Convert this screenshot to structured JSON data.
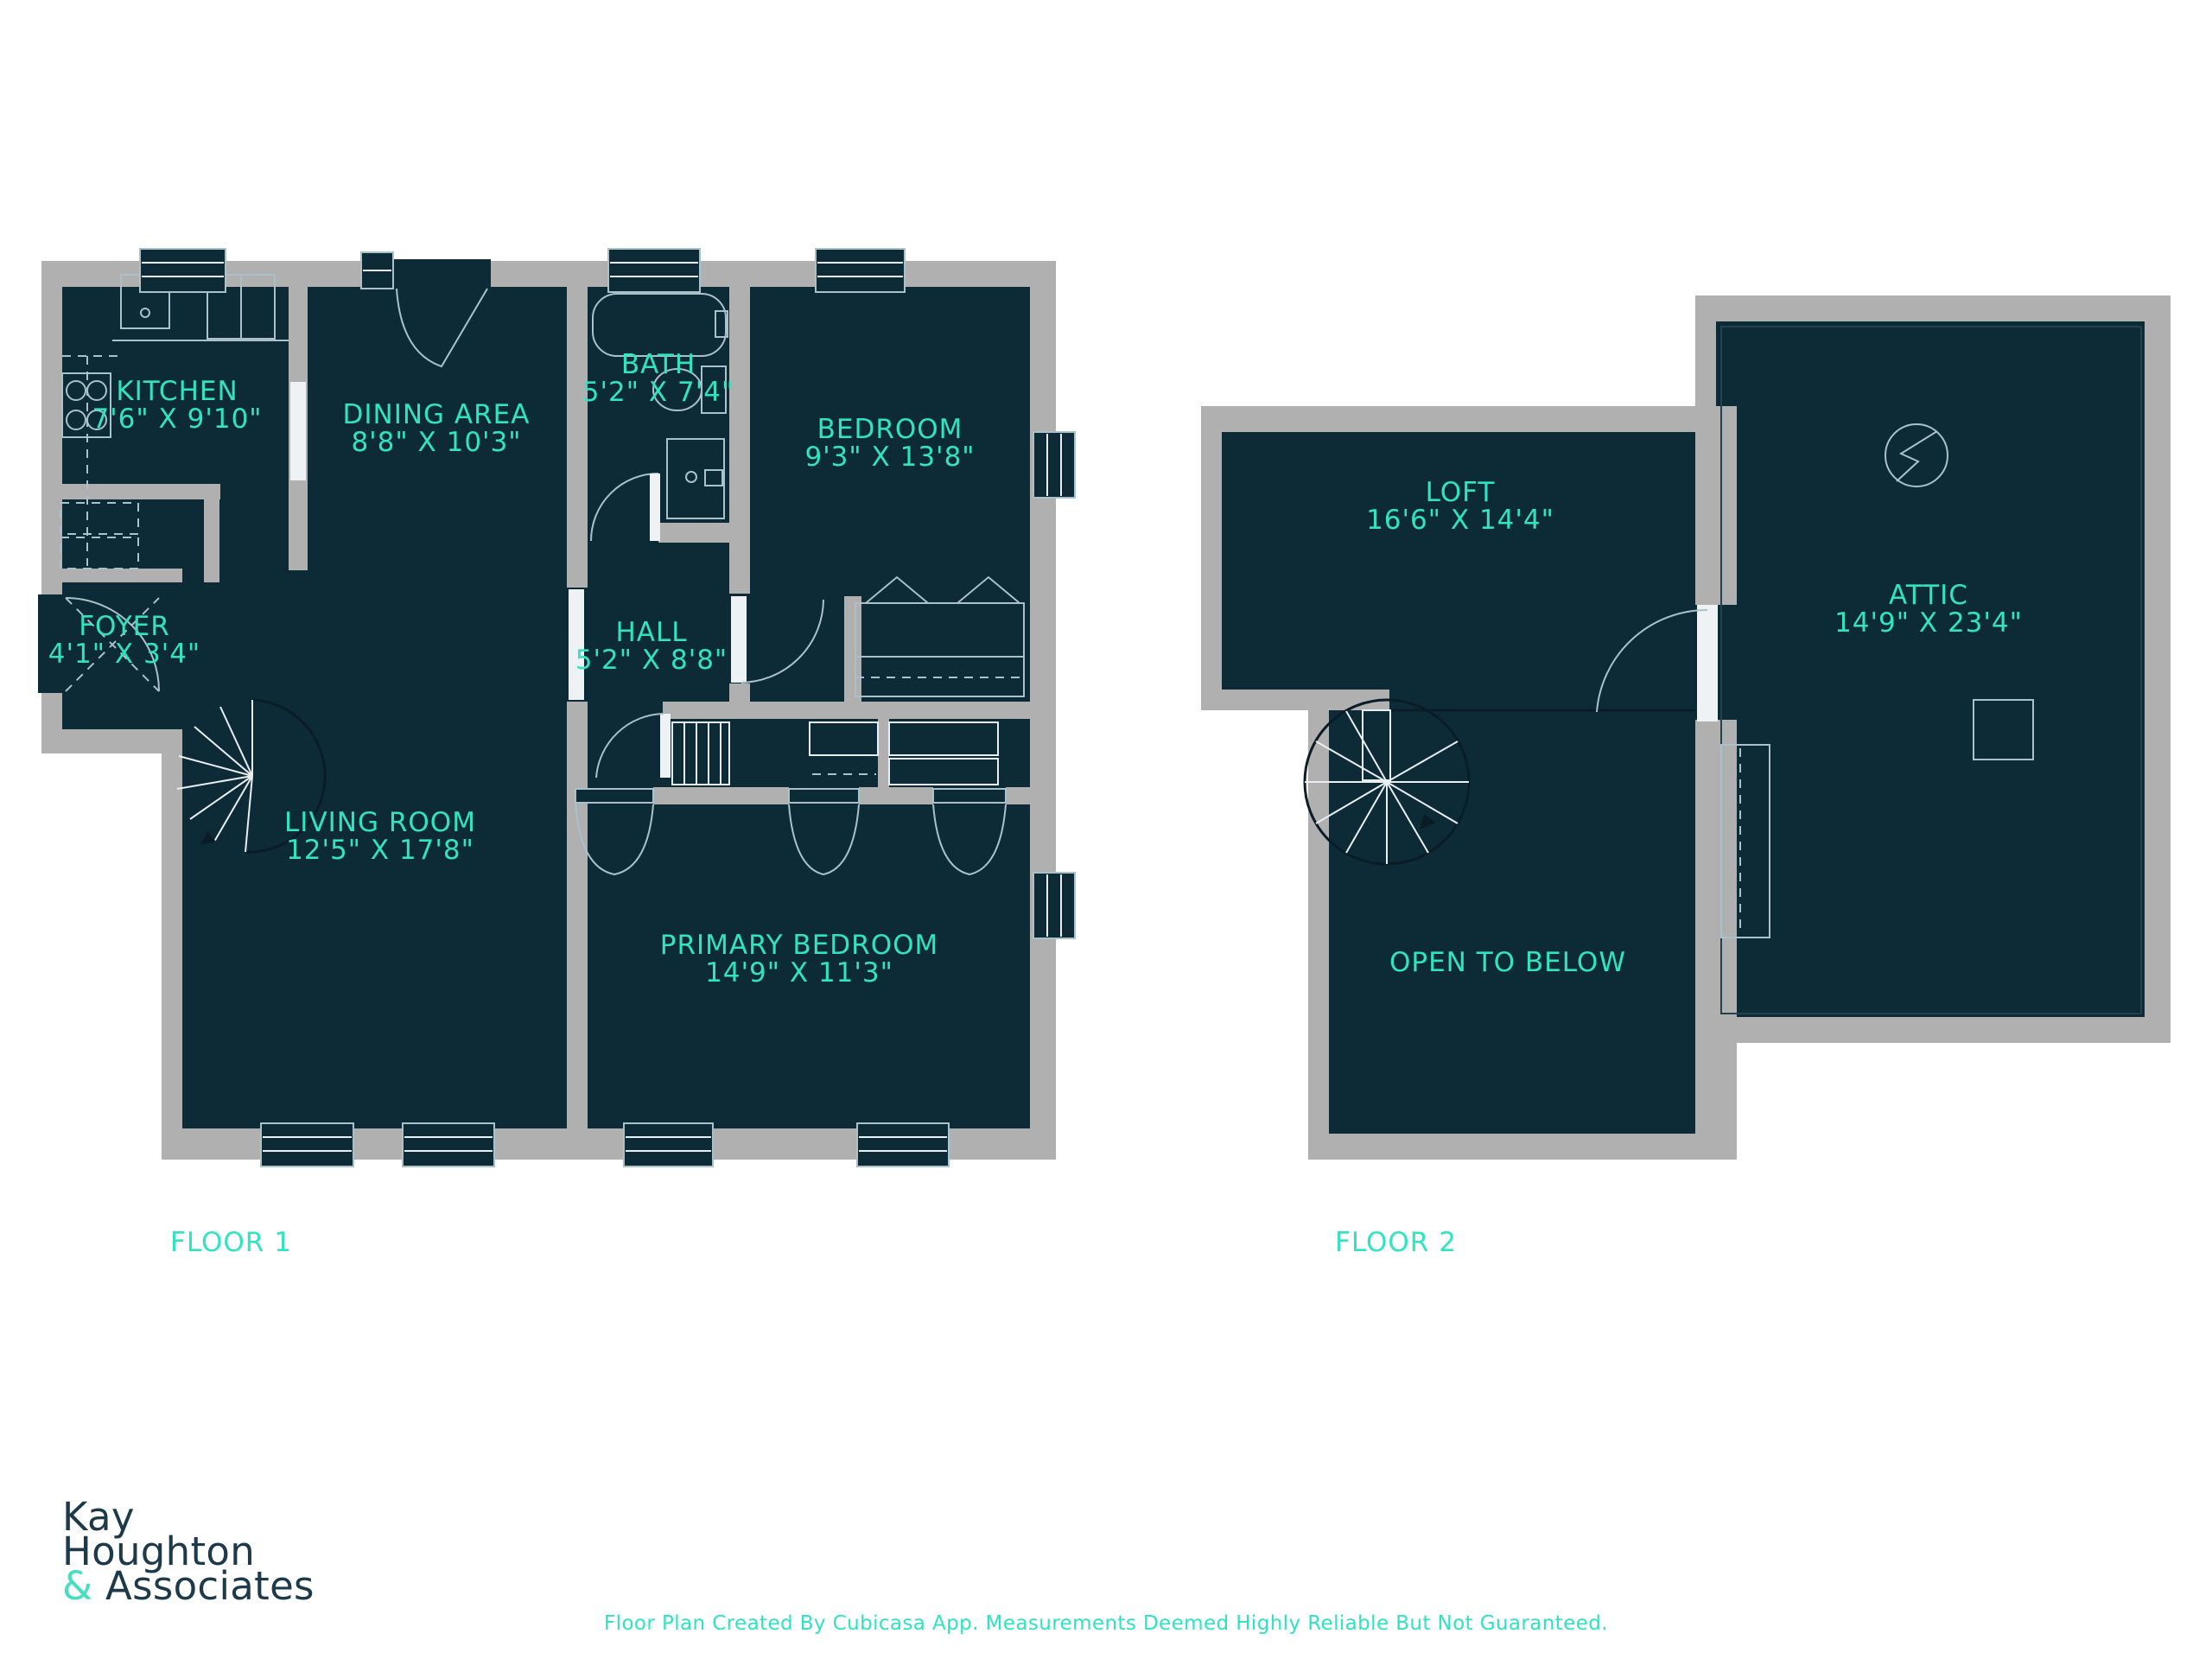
{
  "palette": {
    "room_fill": "#0d2a37",
    "wall_gray": "#b0b0b0",
    "label_teal": "#31e4c1",
    "line_light": "#aac1c9",
    "line_white": "#e9eff1",
    "logo_navy": "#1d3a4b",
    "logo_amp_teal": "#43dfbe"
  },
  "floors": [
    {
      "caption": "FLOOR 1",
      "rooms": [
        {
          "name": "KITCHEN",
          "dims": "7'6\" X 9'10\""
        },
        {
          "name": "DINING AREA",
          "dims": "8'8\" X 10'3\""
        },
        {
          "name": "BATH",
          "dims": "5'2\" X 7'4\""
        },
        {
          "name": "BEDROOM",
          "dims": "9'3\" X 13'8\""
        },
        {
          "name": "FOYER",
          "dims": "4'1\" X 3'4\""
        },
        {
          "name": "HALL",
          "dims": "5'2\" X 8'8\""
        },
        {
          "name": "LIVING ROOM",
          "dims": "12'5\" X 17'8\""
        },
        {
          "name": "PRIMARY BEDROOM",
          "dims": "14'9\" X 11'3\""
        }
      ]
    },
    {
      "caption": "FLOOR 2",
      "rooms": [
        {
          "name": "LOFT",
          "dims": "16'6\" X 14'4\""
        },
        {
          "name": "ATTIC",
          "dims": "14'9\" X 23'4\""
        },
        {
          "name": "OPEN TO BELOW",
          "dims": ""
        }
      ]
    }
  ],
  "icons": {
    "electrical_panel": "circle-lightning-bolt"
  },
  "branding": {
    "logo_line1": "Kay",
    "logo_line2": "Houghton",
    "logo_amp": "&",
    "logo_line3": "Associates",
    "footer": "Floor Plan Created By Cubicasa App. Measurements Deemed Highly Reliable But Not Guaranteed."
  }
}
